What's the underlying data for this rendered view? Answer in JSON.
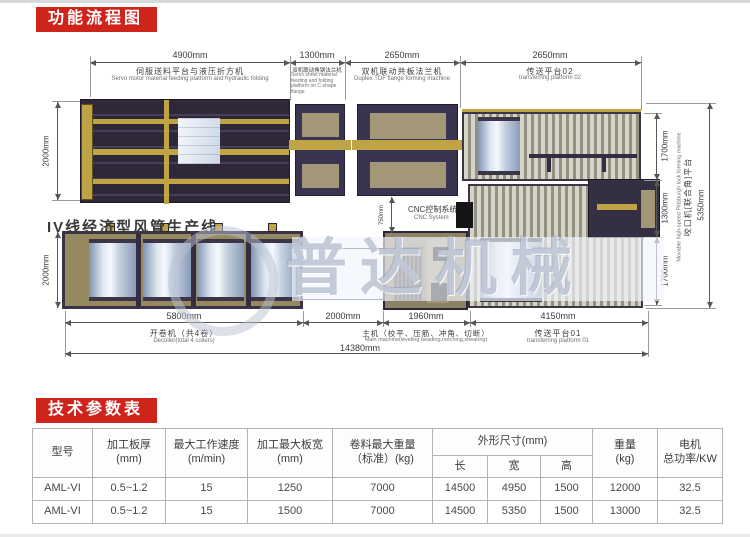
{
  "banners": {
    "flow_chart": "功能流程图",
    "tech_params": "技术参数表"
  },
  "diagram": {
    "line_title": "IV线经济型风管生产线",
    "watermark": "普达机械",
    "top_dims": [
      {
        "len": "4900mm",
        "cn": "伺服送料平台与液压折方机",
        "en": "Servo motor material feeding platform and hydraulic folding"
      },
      {
        "len": "1300mm",
        "cn": "双机联动角钢法兰机",
        "en": "Servo sheet material feeding and folding platform on C-shape flange"
      },
      {
        "len": "2650mm",
        "cn": "双机联动共板法兰机",
        "en": "Duplex TDF flange forming machine"
      },
      {
        "len": "2650mm",
        "cn": "传送平台02",
        "en": "transferring platform 02"
      }
    ],
    "bottom_dims": [
      {
        "len": "5800mm",
        "cn": "开卷机（共4卷）",
        "en": "Decoiler(total 4 coilers)"
      },
      {
        "len": "2000mm",
        "cn": "",
        "en": ""
      },
      {
        "len": "1960mm",
        "cn": "主机（校平、压筋、冲角、切断）",
        "en": "Main machine(leveling beading,notching,shearing)"
      },
      {
        "len": "4150mm",
        "cn": "传送平台01",
        "en": "transferring platform 01"
      }
    ],
    "total_dim": "14380mm",
    "left_dims": [
      "2000mm",
      "2000mm"
    ],
    "right_dims": [
      "1700mm",
      "1300mm",
      "1700mm"
    ],
    "right_total": "5350mm",
    "pittsburgh_cn": "咬口机[联合角]平台",
    "pittsburgh_en": "Movable high-speed Pittsburgh lock forming machine",
    "cnc_cn": "CNC控制系统",
    "cnc_en": "CNC System",
    "cnc_dim": "750mm"
  },
  "table": {
    "headers": {
      "model": "型号",
      "thickness": "加工板厚\n(mm)",
      "speed": "最大工作速度\n(m/min)",
      "width": "加工最大板宽\n(mm)",
      "coil_weight": "卷料最大重量\n（标准）(kg)",
      "dimensions": "外形尺寸(mm)",
      "length": "长",
      "w": "宽",
      "height": "高",
      "weight": "重量\n(kg)",
      "power": "电机\n总功率/KW"
    },
    "rows": [
      [
        "AML-VI",
        "0.5~1.2",
        "15",
        "1250",
        "7000",
        "14500",
        "4950",
        "1500",
        "12000",
        "32.5"
      ],
      [
        "AML-VI",
        "0.5~1.2",
        "15",
        "1500",
        "7000",
        "14500",
        "5350",
        "1500",
        "13000",
        "32.5"
      ]
    ]
  }
}
